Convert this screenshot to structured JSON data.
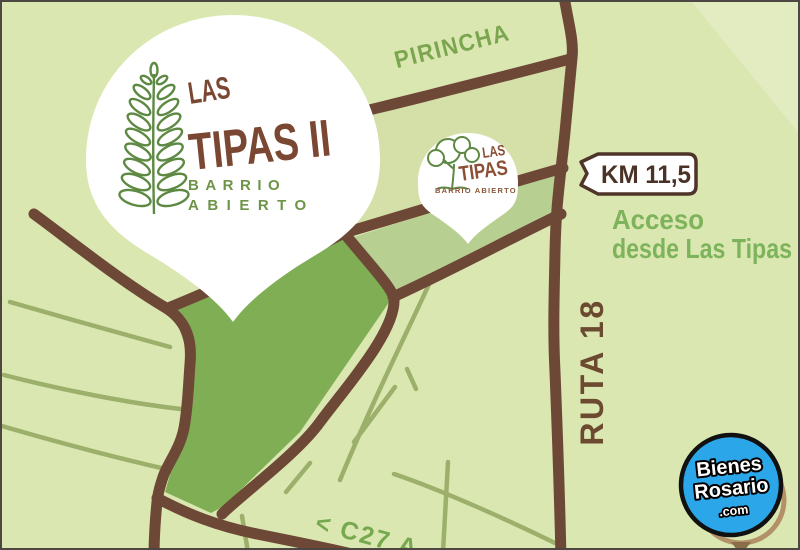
{
  "map": {
    "streets": {
      "pirincha": "PIRINCHA",
      "ruta": "RUTA 18",
      "c27": "< C27 A"
    },
    "km_marker": {
      "label": "KM 11,5"
    },
    "access_note": {
      "line1": "Acceso",
      "line2": "desde Las Tipas"
    },
    "main_pin": {
      "name_line1": "LAS",
      "name_line2": "TIPAS II",
      "tagline_line1": "BARRIO",
      "tagline_line2": "ABIERTO"
    },
    "secondary_pin": {
      "name_line1": "LAS",
      "name_line2": "TIPAS",
      "tagline": "BARRIO ABIERTO"
    },
    "watermark": {
      "line1": "Bienes",
      "line2": "Rosario",
      "line3": ".com"
    },
    "colors": {
      "background": "#dbe7b1",
      "road_brown": "#6e4837",
      "site_green": "#7fae54",
      "strip_green": "#b8cf92",
      "band_green": "#d4e0a8",
      "corner_pale": "#e3ecc1",
      "minor_road_olive": "#9cb06c",
      "street_label_green": "#7ba64f",
      "route_label_brown": "#6b4a30",
      "access_green": "#7db35a",
      "km_brown": "#4a3227",
      "pin_text_brown": "#7a4732",
      "pin_tagline_green": "#6d9447",
      "leaf_green": "#5d8943",
      "watermark_blue": "#2ba7e9",
      "sketch_tan": "#b29068"
    }
  }
}
